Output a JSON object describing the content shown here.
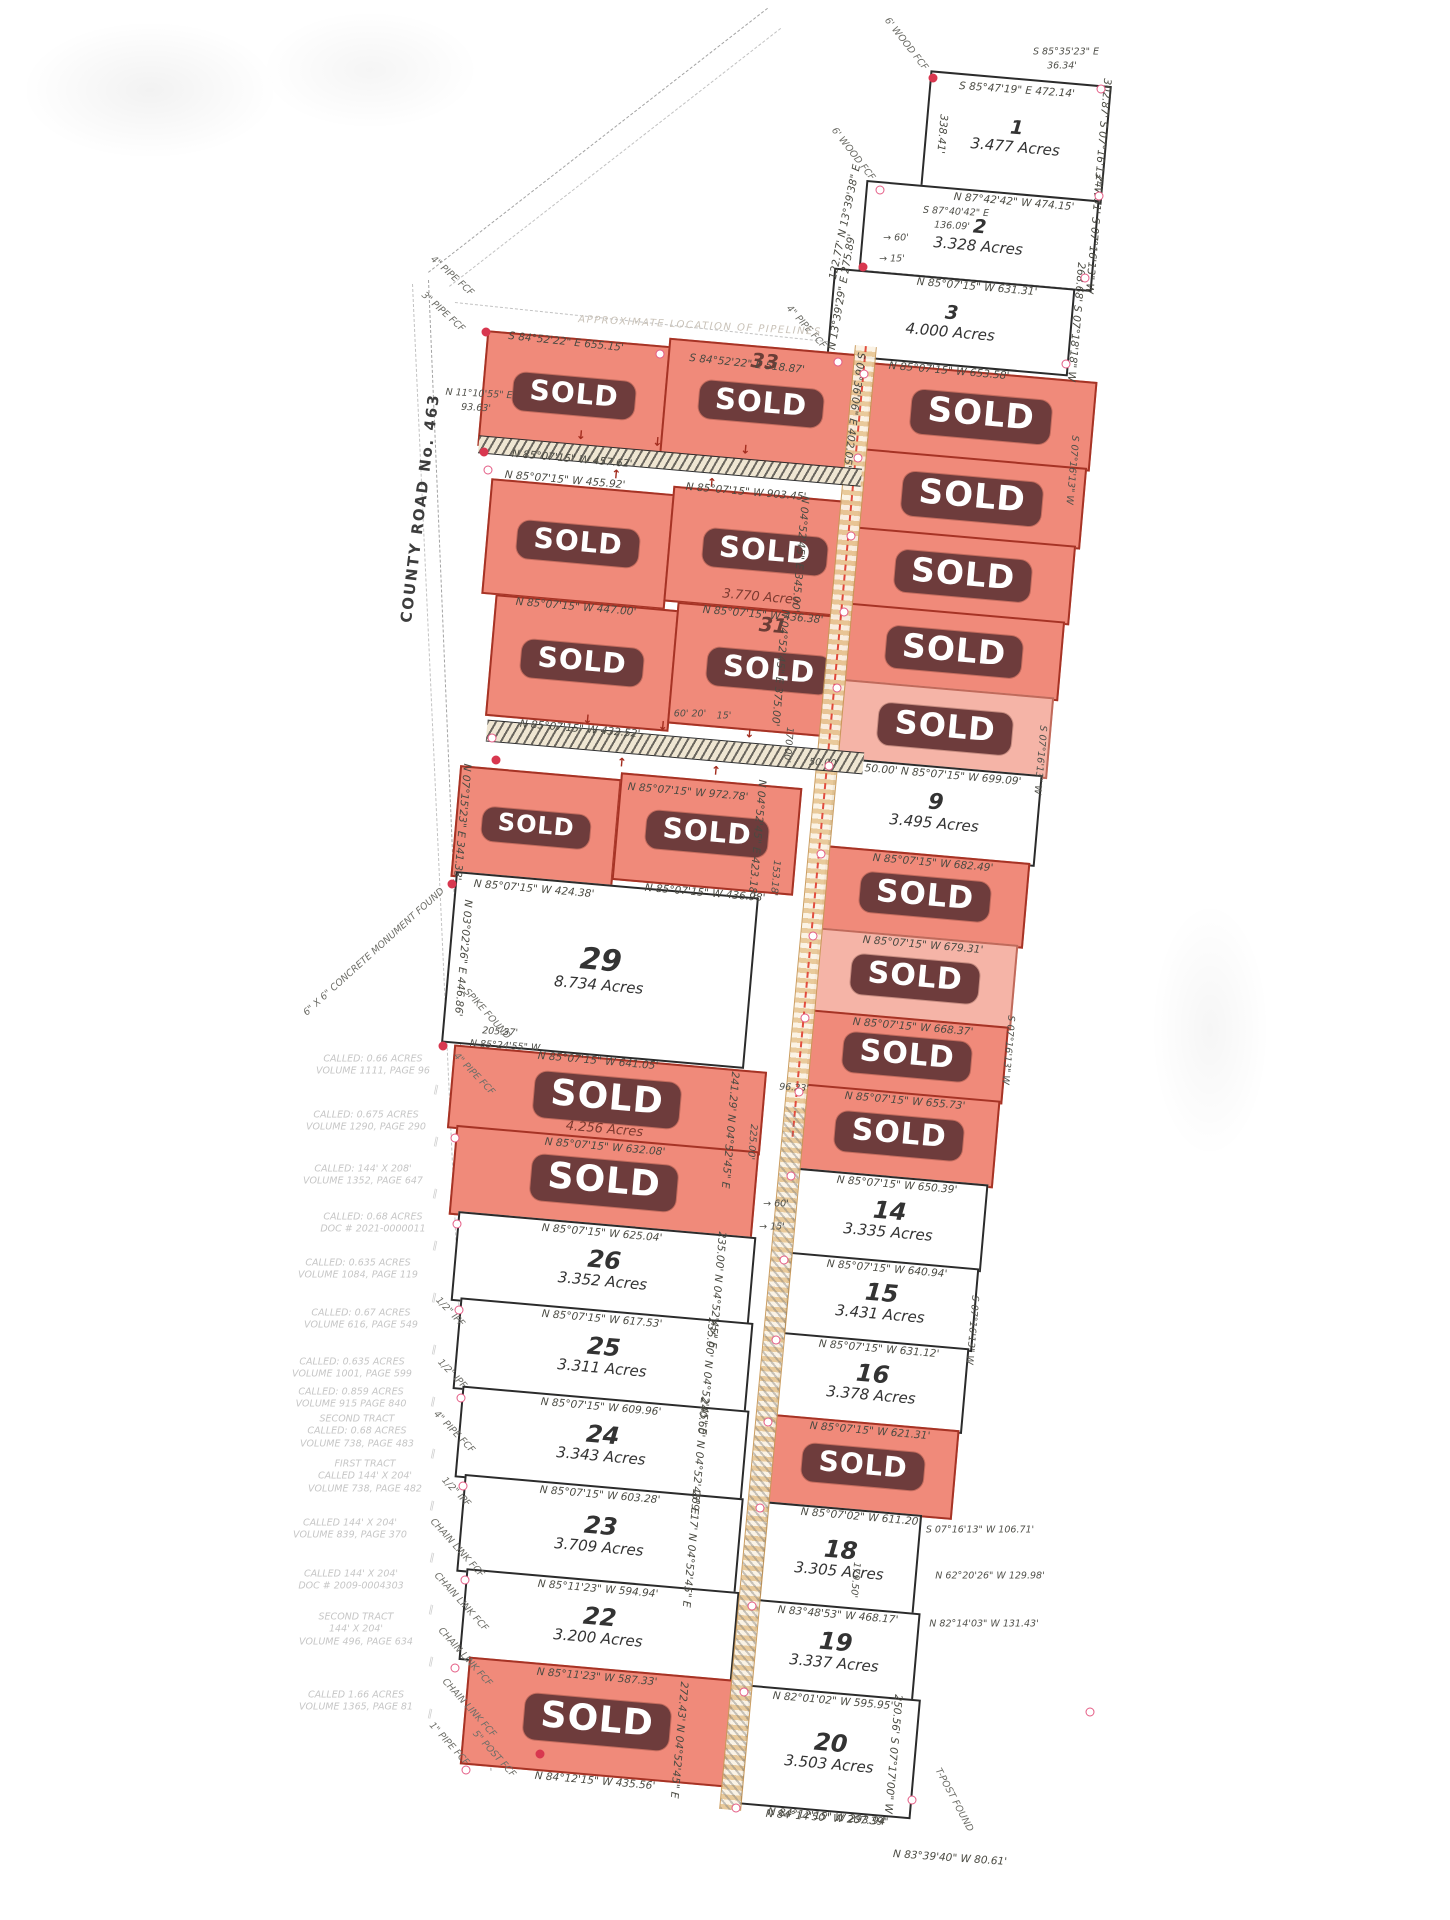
{
  "map": {
    "road_label": "COUNTY ROAD No. 463",
    "sold_label": "SOLD",
    "colors": {
      "sold_fill": "#f08a7a",
      "sold_fill_light": "#f5b4a7",
      "banner": "#6e3c3c",
      "banner_text": "#ffffff",
      "lot_line": "#2b2b2b",
      "sold_line": "#a63325",
      "vertex": "#e45b84",
      "pipeline": "#e8c896",
      "note_text": "#c6c6c6"
    },
    "lots": [
      {
        "id": "1",
        "number": "1",
        "acres": "3.477 Acres",
        "sold": false,
        "ns": 19,
        "x": 925,
        "y": 78,
        "w": 178,
        "h": 115,
        "bottom": "N 87°42'42\" W  474.15'"
      },
      {
        "id": "2",
        "number": "2",
        "acres": "3.328 Acres",
        "sold": false,
        "ns": 19,
        "x": 862,
        "y": 190,
        "w": 230,
        "h": 88,
        "bottom": "N 85°07'15\" W  631.31'"
      },
      {
        "id": "3",
        "number": "3",
        "acres": "4.000 Acres",
        "sold": false,
        "ns": 19,
        "x": 830,
        "y": 278,
        "w": 238,
        "h": 84,
        "bottom": "N 85°07'15\" W  653.58'"
      },
      {
        "id": "r1l",
        "sold": true,
        "x": 482,
        "y": 338,
        "w": 180,
        "h": 112,
        "bottom": "N 85°07'15\" W  457.62'"
      },
      {
        "id": "33",
        "number": "33",
        "sold": true,
        "x": 664,
        "y": 346,
        "w": 190,
        "h": 112
      },
      {
        "id": "r2l",
        "sold": true,
        "x": 486,
        "y": 486,
        "w": 180,
        "h": 112,
        "bottom": "N 85°07'15\" W  447.00'"
      },
      {
        "id": "32",
        "sold": true,
        "acres": "3.770 Acres",
        "x": 668,
        "y": 494,
        "w": 190,
        "h": 112,
        "bottom": "N 85°07'15\" W  436.38'"
      },
      {
        "id": "r3l",
        "sold": true,
        "x": 490,
        "y": 602,
        "w": 180,
        "h": 118,
        "bottom": "N 85°07'15\" W  432.52'"
      },
      {
        "id": "31",
        "number": "31",
        "sold": true,
        "x": 672,
        "y": 610,
        "w": 190,
        "h": 118
      },
      {
        "id": "r4l",
        "sold": true,
        "x": 455,
        "y": 772,
        "w": 158,
        "h": 108,
        "bottom": "N 85°07'15\" W  424.38'"
      },
      {
        "id": "30",
        "sold": true,
        "x": 616,
        "y": 780,
        "w": 178,
        "h": 104,
        "bottom": "N 85°07'15\" W  436.98'"
      },
      {
        "id": "29",
        "number": "29",
        "acres": "8.734 Acres",
        "sold": false,
        "ns": 30,
        "x": 448,
        "y": 884,
        "w": 300,
        "h": 168,
        "bottom": "N 85°07'15\" W  641.05'"
      },
      {
        "id": "28",
        "sold": true,
        "acres": "4.256 Acres",
        "x": 450,
        "y": 1058,
        "w": 310,
        "h": 80,
        "bottom": "N 85°07'15\" W  632.08'"
      },
      {
        "id": "27",
        "sold": true,
        "x": 452,
        "y": 1138,
        "w": 300,
        "h": 86,
        "bottom": "N 85°07'15\" W  625.04'"
      },
      {
        "id": "26",
        "number": "26",
        "acres": "3.352 Acres",
        "sold": false,
        "x": 454,
        "y": 1224,
        "w": 295,
        "h": 86,
        "bottom": "N 85°07'15\" W  617.53'"
      },
      {
        "id": "25",
        "number": "25",
        "acres": "3.311 Acres",
        "sold": false,
        "x": 456,
        "y": 1310,
        "w": 290,
        "h": 88,
        "bottom": "N 85°07'15\" W  609.96'"
      },
      {
        "id": "24",
        "number": "24",
        "acres": "3.343 Acres",
        "sold": false,
        "x": 458,
        "y": 1398,
        "w": 284,
        "h": 88,
        "bottom": "N 85°07'15\" W  603.28'"
      },
      {
        "id": "23",
        "number": "23",
        "acres": "3.709 Acres",
        "sold": false,
        "x": 460,
        "y": 1486,
        "w": 276,
        "h": 94,
        "bottom": "N 85°11'23\" W  594.94'"
      },
      {
        "id": "22",
        "number": "22",
        "acres": "3.200 Acres",
        "sold": false,
        "x": 462,
        "y": 1580,
        "w": 270,
        "h": 88,
        "bottom": "N 85°11'23\" W  587.33'"
      },
      {
        "id": "21",
        "sold": true,
        "x": 464,
        "y": 1668,
        "w": 262,
        "h": 104,
        "bottom": "N 84°12'15\" W  435.56'"
      },
      {
        "id": "4",
        "sold": true,
        "x": 868,
        "y": 372,
        "w": 222,
        "h": 86
      },
      {
        "id": "5",
        "sold": true,
        "x": 860,
        "y": 458,
        "w": 220,
        "h": 78
      },
      {
        "id": "6",
        "sold": true,
        "x": 853,
        "y": 536,
        "w": 216,
        "h": 76
      },
      {
        "id": "7",
        "sold": true,
        "x": 846,
        "y": 612,
        "w": 212,
        "h": 76
      },
      {
        "id": "8",
        "sold": true,
        "light": true,
        "x": 839,
        "y": 688,
        "w": 208,
        "h": 78,
        "bottom": "50.00'   N 85°07'15\" W  699.09'"
      },
      {
        "id": "9",
        "number": "9",
        "acres": "3.495 Acres",
        "sold": false,
        "ns": 22,
        "x": 831,
        "y": 766,
        "w": 204,
        "h": 88,
        "bottom": "N 85°07'15\" W  682.49'"
      },
      {
        "id": "10",
        "sold": true,
        "x": 823,
        "y": 854,
        "w": 200,
        "h": 82,
        "bottom": "N 85°07'15\" W  679.31'"
      },
      {
        "id": "11",
        "sold": true,
        "light": true,
        "x": 815,
        "y": 936,
        "w": 196,
        "h": 82,
        "bottom": "N 85°07'15\" W  668.37'"
      },
      {
        "id": "12",
        "sold": true,
        "x": 808,
        "y": 1018,
        "w": 194,
        "h": 74,
        "bottom": "N 85°07'15\" W  655.73'"
      },
      {
        "id": "13",
        "sold": true,
        "x": 801,
        "y": 1092,
        "w": 192,
        "h": 84,
        "bottom": "N 85°07'15\" W  650.39'"
      },
      {
        "id": "14",
        "number": "14",
        "acres": "3.335 Acres",
        "sold": false,
        "x": 793,
        "y": 1176,
        "w": 188,
        "h": 84,
        "bottom": "N 85°07'15\" W  640.94'"
      },
      {
        "id": "15",
        "number": "15",
        "acres": "3.431 Acres",
        "sold": false,
        "x": 786,
        "y": 1260,
        "w": 186,
        "h": 80,
        "bottom": "N 85°07'15\" W  631.12'"
      },
      {
        "id": "16",
        "number": "16",
        "acres": "3.378 Acres",
        "sold": false,
        "x": 778,
        "y": 1340,
        "w": 184,
        "h": 82,
        "bottom": "N 85°07'15\" W  621.31'"
      },
      {
        "id": "17",
        "sold": true,
        "x": 770,
        "y": 1422,
        "w": 182,
        "h": 86,
        "bottom": "N 85°07'02\" W  611.20'"
      },
      {
        "id": "18",
        "number": "18",
        "acres": "3.305 Acres",
        "sold": false,
        "x": 762,
        "y": 1508,
        "w": 152,
        "h": 98,
        "bottom": "N 83°48'53\" W  468.17'"
      },
      {
        "id": "19",
        "number": "19",
        "acres": "3.337 Acres",
        "sold": false,
        "x": 753,
        "y": 1606,
        "w": 160,
        "h": 86,
        "bottom": "N 82°01'02\" W  595.95'"
      },
      {
        "id": "20",
        "number": "20",
        "acres": "3.503 Acres",
        "sold": false,
        "x": 744,
        "y": 1692,
        "w": 168,
        "h": 116,
        "bottom": "N 84°12'15\" W  293.94'"
      }
    ],
    "strips": [
      {
        "x": 478,
        "y": 452,
        "w": 384,
        "h": 16
      },
      {
        "x": 486,
        "y": 736,
        "w": 378,
        "h": 20
      }
    ],
    "labels": [
      [
        "S 85°47'19\" E  472.14'",
        1017,
        90,
        4,
        "b"
      ],
      [
        "S 85°35'23\" E",
        1066,
        52,
        0,
        "s"
      ],
      [
        "36.34'",
        1062,
        66,
        0,
        "s"
      ],
      [
        "302.87'  S 07°16'13\" W",
        1102,
        138,
        95,
        "b"
      ],
      [
        "338.41'",
        942,
        134,
        95,
        "b"
      ],
      [
        "S 87°40'42\" E",
        956,
        212,
        3,
        "s"
      ],
      [
        "136.09'",
        952,
        226,
        3,
        "s"
      ],
      [
        "247.61'  S 07°16'13\" W",
        1094,
        234,
        95,
        "b"
      ],
      [
        "268.68'  S 07°18'18\" W",
        1076,
        322,
        95,
        "b"
      ],
      [
        "122.77'  N 13°39'38\" E",
        845,
        222,
        -78,
        "b"
      ],
      [
        "→ 60'",
        896,
        238,
        0,
        "s"
      ],
      [
        "→ 15'",
        892,
        259,
        0,
        "s"
      ],
      [
        "N 13°39'29\" E  275.89'",
        842,
        292,
        -80,
        "b"
      ],
      [
        "4\" PIPE FCF",
        806,
        327,
        48,
        "f"
      ],
      [
        "4\" PIPE FCF",
        452,
        276,
        42,
        "f"
      ],
      [
        "3\" PIPE FCF",
        443,
        312,
        42,
        "f"
      ],
      [
        "6' WOOD FCF",
        906,
        44,
        52,
        "f"
      ],
      [
        "6' WOOD FCF",
        853,
        154,
        52,
        "f"
      ],
      [
        "APPROXIMATE LOCATION OF PIPELINES",
        700,
        326,
        3,
        "x"
      ],
      [
        "S 84°52'22\" E  655.15'",
        566,
        342,
        6,
        "b"
      ],
      [
        "S 84°52'22\" E  518.87'",
        747,
        364,
        6,
        "b"
      ],
      [
        "N 11°10'55\" E",
        479,
        394,
        3,
        "s"
      ],
      [
        "93.63'",
        476,
        408,
        3,
        "s"
      ],
      [
        "S 06°36'06\" E  402.05'",
        854,
        410,
        97,
        "b"
      ],
      [
        "N 85°07'15\" W  455.92'",
        565,
        480,
        5,
        "b"
      ],
      [
        "N 85°07'15\" W  903.45'",
        746,
        492,
        5,
        "b"
      ],
      [
        "N 04°52'45\" E  345.00'",
        800,
        554,
        95,
        "b"
      ],
      [
        "N 04°52'45\" E  375.00'",
        780,
        668,
        95,
        "b"
      ],
      [
        "170.00'",
        788,
        745,
        95,
        "s"
      ],
      [
        "60'  20'",
        690,
        714,
        0,
        "s"
      ],
      [
        "15'",
        724,
        716,
        0,
        "s"
      ],
      [
        "N 85°07'15\" W  972.78'",
        688,
        792,
        5,
        "b"
      ],
      [
        "50.00'",
        824,
        763,
        3,
        "s"
      ],
      [
        "N 04°52'45\" E  423.18'",
        757,
        838,
        95,
        "b"
      ],
      [
        "153.18'",
        775,
        878,
        95,
        "s"
      ],
      [
        "N 07°15'23\" E  341.33'",
        462,
        822,
        95,
        "b"
      ],
      [
        "SPIKE FOUND",
        487,
        1014,
        48,
        "f"
      ],
      [
        "6\" X 6\" CONCRETE MONUMENT FOUND",
        374,
        952,
        -42,
        "f"
      ],
      [
        "205.37'",
        500,
        1032,
        4,
        "s"
      ],
      [
        "N 85°24'55\" W",
        505,
        1046,
        4,
        "s"
      ],
      [
        "N 03°02'26\" E  446.86'",
        463,
        958,
        95,
        "b"
      ],
      [
        "96.23'",
        794,
        1088,
        4,
        "s"
      ],
      [
        "241.29'  N 04°52'45\" E",
        730,
        1130,
        95,
        "b"
      ],
      [
        "225.00'",
        752,
        1142,
        95,
        "s"
      ],
      [
        "→ 60'",
        776,
        1204,
        0,
        "s"
      ],
      [
        "→ 15'",
        772,
        1227,
        0,
        "s"
      ],
      [
        "235.00'  N 04°52'45\" E",
        717,
        1290,
        95,
        "b"
      ],
      [
        "235.00'  N 04°52'45\" E",
        707,
        1376,
        95,
        "b"
      ],
      [
        "240.60'  N 04°52'45\" E",
        699,
        1456,
        95,
        "b"
      ],
      [
        "269.17'  N 04°52'45\" E",
        691,
        1549,
        95,
        "b"
      ],
      [
        "272.43'  N 04°52'45\" E",
        679,
        1740,
        95,
        "b"
      ],
      [
        "250.56'  S 07°17'00\" W",
        893,
        1754,
        95,
        "b"
      ],
      [
        "179.50'",
        855,
        1580,
        95,
        "s"
      ],
      [
        "N 84°14'50\" W  207.39'",
        826,
        1818,
        4,
        "b"
      ],
      [
        "N 83°39'40\" W  80.61'",
        950,
        1858,
        4,
        "b"
      ],
      [
        "S 07°16'13\" W  106.71'",
        980,
        1530,
        0,
        "s"
      ],
      [
        "N 62°20'26\" W  129.98'",
        990,
        1576,
        0,
        "s"
      ],
      [
        "N 82°14'03\" W  131.43'",
        984,
        1624,
        0,
        "s"
      ],
      [
        "T-POST FOUND",
        954,
        1800,
        62,
        "f"
      ],
      [
        "S 07°16'13\" W",
        1072,
        470,
        95,
        "s"
      ],
      [
        "S 07°16'13\" W",
        1040,
        760,
        95,
        "s"
      ],
      [
        "S 07°16'13\" W",
        1008,
        1050,
        95,
        "s"
      ],
      [
        "S 07°16'13\" W",
        972,
        1330,
        95,
        "s"
      ],
      [
        "4\" PIPE FCF",
        474,
        1074,
        46,
        "f"
      ],
      [
        "1/2\" IPF",
        450,
        1312,
        46,
        "f"
      ],
      [
        "1/2\" IPF",
        452,
        1374,
        46,
        "f"
      ],
      [
        "4\" PIPE FCF",
        454,
        1432,
        46,
        "f"
      ],
      [
        "1/2\" IPF",
        456,
        1492,
        46,
        "f"
      ],
      [
        "CHAIN LINK FCF",
        457,
        1548,
        48,
        "f"
      ],
      [
        "CHAIN LINK FCF",
        461,
        1602,
        48,
        "f"
      ],
      [
        "CHAIN LINK FCF",
        465,
        1657,
        48,
        "f"
      ],
      [
        "CHAIN LINK FCF",
        469,
        1708,
        48,
        "f"
      ],
      [
        "1\" PIPE FCF",
        449,
        1744,
        48,
        "f"
      ],
      [
        "5\" POST FCF",
        494,
        1754,
        48,
        "f"
      ]
    ],
    "margin_notes": [
      {
        "text": "CALLED: 0.66 ACRES\nVOLUME 1111, PAGE 96",
        "x": 373,
        "y": 1066
      },
      {
        "text": "CALLED: 0.675 ACRES\nVOLUME 1290, PAGE 290",
        "x": 366,
        "y": 1122
      },
      {
        "text": "CALLED: 144' X 208'\nVOLUME 1352, PAGE 647",
        "x": 363,
        "y": 1176
      },
      {
        "text": "CALLED: 0.68 ACRES\nDOC # 2021-0000011",
        "x": 373,
        "y": 1224
      },
      {
        "text": "CALLED: 0.635 ACRES\nVOLUME 1084, PAGE 119",
        "x": 358,
        "y": 1270
      },
      {
        "text": "CALLED: 0.67 ACRES\nVOLUME 616, PAGE 549",
        "x": 361,
        "y": 1320
      },
      {
        "text": "CALLED: 0.635 ACRES\nVOLUME 1001, PAGE 599",
        "x": 352,
        "y": 1369
      },
      {
        "text": "CALLED: 0.859 ACRES\nVOLUME 915 PAGE 840",
        "x": 351,
        "y": 1399
      },
      {
        "text": "SECOND TRACT\nCALLED: 0.68 ACRES\nVOLUME 738, PAGE 483",
        "x": 357,
        "y": 1432
      },
      {
        "text": "FIRST TRACT\nCALLED 144' X 204'\nVOLUME 738, PAGE 482",
        "x": 365,
        "y": 1477
      },
      {
        "text": "CALLED 144' X 204'\nVOLUME 839, PAGE 370",
        "x": 350,
        "y": 1530
      },
      {
        "text": "CALLED 144' X 204'\nDOC # 2009-0004303",
        "x": 351,
        "y": 1581
      },
      {
        "text": "SECOND TRACT\n144' X 204'\nVOLUME 496, PAGE 634",
        "x": 356,
        "y": 1630
      },
      {
        "text": "CALLED 1.66 ACRES\nVOLUME 1365, PAGE 81",
        "x": 356,
        "y": 1702
      }
    ],
    "vertices": [
      [
        933,
        78,
        1
      ],
      [
        1101,
        89,
        0
      ],
      [
        1099,
        196,
        0
      ],
      [
        880,
        190,
        0
      ],
      [
        863,
        267,
        1
      ],
      [
        1085,
        278,
        0
      ],
      [
        838,
        362,
        0
      ],
      [
        1066,
        364,
        0
      ],
      [
        486,
        332,
        1
      ],
      [
        660,
        354,
        0
      ],
      [
        864,
        374,
        0
      ],
      [
        858,
        458,
        0
      ],
      [
        851,
        536,
        0
      ],
      [
        844,
        612,
        0
      ],
      [
        837,
        688,
        0
      ],
      [
        829,
        766,
        0
      ],
      [
        821,
        854,
        0
      ],
      [
        813,
        936,
        0
      ],
      [
        805,
        1018,
        0
      ],
      [
        799,
        1092,
        0
      ],
      [
        791,
        1176,
        0
      ],
      [
        784,
        1260,
        0
      ],
      [
        776,
        1340,
        0
      ],
      [
        768,
        1422,
        0
      ],
      [
        760,
        1508,
        0
      ],
      [
        752,
        1606,
        0
      ],
      [
        744,
        1692,
        0
      ],
      [
        736,
        1808,
        0
      ],
      [
        912,
        1800,
        0
      ],
      [
        1090,
        1712,
        0
      ],
      [
        452,
        884,
        1
      ],
      [
        443,
        1046,
        1
      ],
      [
        455,
        1668,
        0
      ],
      [
        466,
        1770,
        0
      ],
      [
        540,
        1754,
        1
      ],
      [
        484,
        452,
        1
      ],
      [
        488,
        470,
        0
      ],
      [
        492,
        738,
        0
      ],
      [
        496,
        760,
        1
      ],
      [
        455,
        1138,
        0
      ],
      [
        457,
        1224,
        0
      ],
      [
        459,
        1310,
        0
      ],
      [
        461,
        1398,
        0
      ],
      [
        463,
        1486,
        0
      ],
      [
        465,
        1580,
        0
      ]
    ]
  }
}
